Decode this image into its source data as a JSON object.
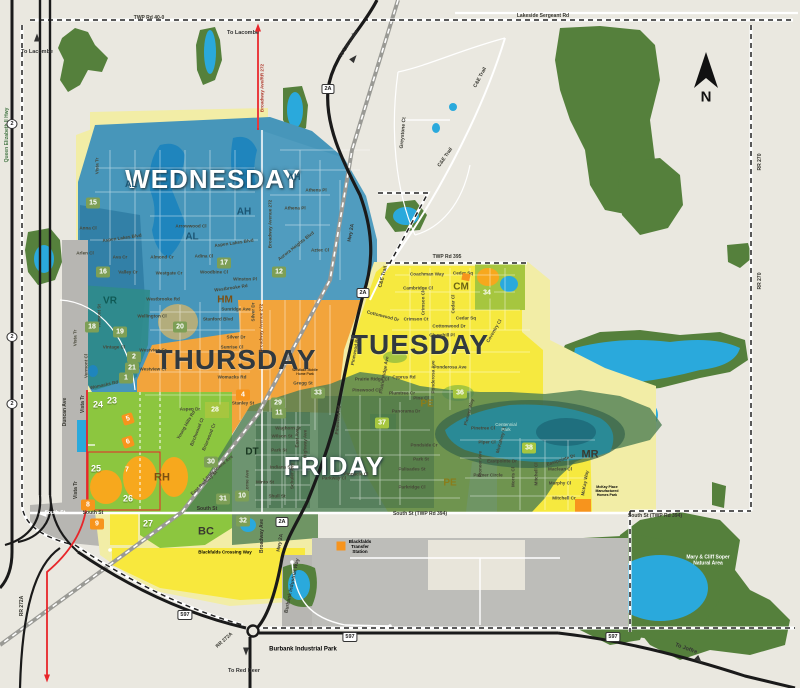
{
  "map": {
    "colors": {
      "background": "#eae8e0",
      "forest": "#55803c",
      "water": "#2aa9dc",
      "wednesday_zone": "#4796ba",
      "thursday_zone": "#f2a43c",
      "tuesday_zone": "#f6e93f",
      "friday_zone": "#4e7e54",
      "collection_green_zone": "#8cc63f",
      "pale_yellow_zone": "#f2eda6",
      "gray_zone": "#b7b6b2",
      "highway": "#1a1a1a",
      "route_red": "#e8262a",
      "marker_green": "#7d9f56",
      "marker_lime": "#a6c63f",
      "marker_orange": "#f7941d"
    },
    "compass": {
      "label": "N"
    },
    "day_zones": [
      {
        "t": "WEDNESDAY",
        "x": 213,
        "y": 180,
        "fs": 26,
        "cls": "day-light"
      },
      {
        "t": "THURSDAY",
        "x": 236,
        "y": 360,
        "fs": 28,
        "cls": "day-dark"
      },
      {
        "t": "TUESDAY",
        "x": 420,
        "y": 345,
        "fs": 28,
        "cls": "day-dark"
      },
      {
        "t": "FRIDAY",
        "x": 334,
        "y": 467,
        "fs": 26,
        "cls": "day-light"
      }
    ],
    "area_codes": [
      {
        "t": "AH",
        "x": 244,
        "y": 212,
        "fs": 10,
        "c": "#1c5674"
      },
      {
        "t": "AH",
        "x": 294,
        "y": 177,
        "fs": 9,
        "c": "#1c5674"
      },
      {
        "t": "AL",
        "x": 131,
        "y": 184,
        "fs": 9,
        "c": "#1c5674"
      },
      {
        "t": "AL",
        "x": 192,
        "y": 237,
        "fs": 10,
        "c": "#1c5674"
      },
      {
        "t": "VR",
        "x": 110,
        "y": 301,
        "fs": 10,
        "c": "#0f5a55"
      },
      {
        "t": "HM",
        "x": 225,
        "y": 300,
        "fs": 10,
        "c": "#7c4f12"
      },
      {
        "t": "CM",
        "x": 461,
        "y": 287,
        "fs": 10,
        "c": "#6b6414"
      },
      {
        "t": "PE",
        "x": 427,
        "y": 404,
        "fs": 10,
        "c": "#8a7d1a"
      },
      {
        "t": "PE",
        "x": 450,
        "y": 483,
        "fs": 10,
        "c": "#8a7d1a"
      },
      {
        "t": "DT",
        "x": 252,
        "y": 452,
        "fs": 10,
        "c": "#17351f"
      },
      {
        "t": "RH",
        "x": 162,
        "y": 478,
        "fs": 11,
        "c": "#7c4f12"
      },
      {
        "t": "BC",
        "x": 206,
        "y": 532,
        "fs": 11,
        "c": "#3a3a30"
      },
      {
        "t": "MR",
        "x": 590,
        "y": 455,
        "fs": 11,
        "c": "#3a3a30"
      }
    ],
    "markers": [
      {
        "t": "12",
        "x": 279,
        "y": 272,
        "cls": "green"
      },
      {
        "t": "15",
        "x": 93,
        "y": 203,
        "cls": "green"
      },
      {
        "t": "16",
        "x": 103,
        "y": 272,
        "cls": "green"
      },
      {
        "t": "17",
        "x": 224,
        "y": 263,
        "cls": "green"
      },
      {
        "t": "18",
        "x": 92,
        "y": 327,
        "cls": "green"
      },
      {
        "t": "19",
        "x": 120,
        "y": 332,
        "cls": "green"
      },
      {
        "t": "20",
        "x": 180,
        "y": 327,
        "cls": "green"
      },
      {
        "t": "2",
        "x": 134,
        "y": 357,
        "cls": "green"
      },
      {
        "t": "21",
        "x": 132,
        "y": 368,
        "cls": "green"
      },
      {
        "t": "1",
        "x": 126,
        "y": 378,
        "cls": "green"
      },
      {
        "t": "29",
        "x": 278,
        "y": 403,
        "cls": "green"
      },
      {
        "t": "11",
        "x": 279,
        "y": 413,
        "cls": "green"
      },
      {
        "t": "33",
        "x": 318,
        "y": 393,
        "cls": "green"
      },
      {
        "t": "30",
        "x": 211,
        "y": 462,
        "cls": "green"
      },
      {
        "t": "31",
        "x": 223,
        "y": 499,
        "cls": "green"
      },
      {
        "t": "10",
        "x": 242,
        "y": 496,
        "cls": "green"
      },
      {
        "t": "32",
        "x": 243,
        "y": 521,
        "cls": "green"
      },
      {
        "t": "34",
        "x": 487,
        "y": 293,
        "cls": "lime"
      },
      {
        "t": "36",
        "x": 460,
        "y": 393,
        "cls": "lime"
      },
      {
        "t": "37",
        "x": 382,
        "y": 423,
        "cls": "lime"
      },
      {
        "t": "28",
        "x": 215,
        "y": 410,
        "cls": "lime"
      },
      {
        "t": "38",
        "x": 529,
        "y": 448,
        "cls": "lime"
      },
      {
        "t": "4",
        "x": 243,
        "y": 395,
        "cls": "orange"
      },
      {
        "t": "8",
        "x": 88,
        "y": 505,
        "cls": "orange"
      },
      {
        "t": "9",
        "x": 97,
        "y": 524,
        "cls": "orange"
      },
      {
        "t": "5",
        "x": 128,
        "y": 419,
        "cls": "tilt"
      },
      {
        "t": "6",
        "x": 128,
        "y": 442,
        "cls": "tilt"
      },
      {
        "t": "7",
        "x": 127,
        "y": 470,
        "cls": "t ilt"
      },
      {
        "t": "23",
        "x": 112,
        "y": 400,
        "cls": "plain"
      },
      {
        "t": "24",
        "x": 98,
        "y": 404,
        "cls": "plain"
      },
      {
        "t": "25",
        "x": 96,
        "y": 468,
        "cls": "plain"
      },
      {
        "t": "26",
        "x": 128,
        "y": 498,
        "cls": "plain"
      },
      {
        "t": "27",
        "x": 148,
        "y": 523,
        "cls": "plain"
      }
    ],
    "streets": [
      {
        "t": "Vista Tr",
        "x": 97,
        "y": 166,
        "r": -90
      },
      {
        "t": "Anna Cl",
        "x": 88,
        "y": 228
      },
      {
        "t": "Aspen Lakes Blvd",
        "x": 122,
        "y": 238,
        "r": -8
      },
      {
        "t": "Arlen Cl",
        "x": 85,
        "y": 253
      },
      {
        "t": "Ava Cr",
        "x": 120,
        "y": 257
      },
      {
        "t": "Valley Cr",
        "x": 128,
        "y": 272
      },
      {
        "t": "Westgate Cr",
        "x": 169,
        "y": 273
      },
      {
        "t": "Almond Cr",
        "x": 162,
        "y": 257
      },
      {
        "t": "Adina Cl",
        "x": 204,
        "y": 256
      },
      {
        "t": "Woodbine Cl",
        "x": 214,
        "y": 272
      },
      {
        "t": "Arrowwood Cl",
        "x": 191,
        "y": 226
      },
      {
        "t": "Aspen Lakes Blvd",
        "x": 234,
        "y": 243,
        "r": -8
      },
      {
        "t": "Athena Pl",
        "x": 295,
        "y": 208
      },
      {
        "t": "Athens Pl",
        "x": 316,
        "y": 190
      },
      {
        "t": "Aurora Heights Blvd",
        "x": 296,
        "y": 246,
        "r": -38
      },
      {
        "t": "Aztec Cl",
        "x": 320,
        "y": 250
      },
      {
        "t": "Winston Pl",
        "x": 245,
        "y": 279
      },
      {
        "t": "Westbrooke Rd",
        "x": 163,
        "y": 299
      },
      {
        "t": "Westbrooke Rd",
        "x": 231,
        "y": 288,
        "r": -8
      },
      {
        "t": "Wellington Cl",
        "x": 152,
        "y": 316
      },
      {
        "t": "Vista Tr",
        "x": 75,
        "y": 338,
        "r": -90
      },
      {
        "t": "Valmont St",
        "x": 99,
        "y": 316,
        "r": -90
      },
      {
        "t": "Vintage Cl",
        "x": 114,
        "y": 347
      },
      {
        "t": "Vermont Cl",
        "x": 86,
        "y": 366,
        "r": -90
      },
      {
        "t": "Womacks Rd",
        "x": 104,
        "y": 385,
        "r": -12
      },
      {
        "t": "Broadway Ave/RR 272",
        "x": 262,
        "y": 88,
        "r": -90,
        "c": "#b03a2e"
      },
      {
        "t": "Broadway Avenue 272",
        "x": 270,
        "y": 224,
        "r": -90
      },
      {
        "t": "Sunridge Ave",
        "x": 236,
        "y": 309
      },
      {
        "t": "Stanford Blvd",
        "x": 218,
        "y": 319
      },
      {
        "t": "Silver Dr",
        "x": 236,
        "y": 337
      },
      {
        "t": "Silver Dr",
        "x": 253,
        "y": 312,
        "r": -90
      },
      {
        "t": "Sunrise Cl",
        "x": 232,
        "y": 347
      },
      {
        "t": "Westview Cr",
        "x": 153,
        "y": 350
      },
      {
        "t": "Westview Cr",
        "x": 153,
        "y": 369
      },
      {
        "t": "Womacks Rd",
        "x": 232,
        "y": 377
      },
      {
        "t": "Stanley St",
        "x": 243,
        "y": 403
      },
      {
        "t": "Aspen Dr",
        "x": 190,
        "y": 409
      },
      {
        "t": "Gregg St",
        "x": 303,
        "y": 383
      },
      {
        "t": "Broadway Avenue 272",
        "x": 261,
        "y": 328,
        "r": -90,
        "c": "#8a4a1a"
      },
      {
        "t": "Young Hills Rd",
        "x": 186,
        "y": 425,
        "r": -60
      },
      {
        "t": "Birchwood Cl",
        "x": 197,
        "y": 432,
        "r": -68
      },
      {
        "t": "Briarwood Cr",
        "x": 209,
        "y": 437,
        "r": -68
      },
      {
        "t": "Landsdowne Ave",
        "x": 218,
        "y": 468,
        "r": -40
      },
      {
        "t": "East Railway St",
        "x": 204,
        "y": 483,
        "r": -42
      },
      {
        "t": "Waghorn St",
        "x": 288,
        "y": 428
      },
      {
        "t": "Wilson St",
        "x": 282,
        "y": 436
      },
      {
        "t": "Park St",
        "x": 279,
        "y": 450
      },
      {
        "t": "Indiana St",
        "x": 281,
        "y": 467
      },
      {
        "t": "Minto St",
        "x": 265,
        "y": 482
      },
      {
        "t": "Shull St",
        "x": 277,
        "y": 496
      },
      {
        "t": "East Ave",
        "x": 297,
        "y": 438,
        "r": -90
      },
      {
        "t": "Highway Ave",
        "x": 305,
        "y": 444,
        "r": -90
      },
      {
        "t": "Schuler Ave",
        "x": 292,
        "y": 476,
        "r": -90
      },
      {
        "t": "Lorne Ave",
        "x": 247,
        "y": 481,
        "r": -90
      },
      {
        "t": "Panorama Dr",
        "x": 406,
        "y": 411
      },
      {
        "t": "Pondside Cr",
        "x": 424,
        "y": 445
      },
      {
        "t": "Park St",
        "x": 421,
        "y": 459
      },
      {
        "t": "Palisades St",
        "x": 412,
        "y": 469
      },
      {
        "t": "Parkridge Cl",
        "x": 412,
        "y": 487
      },
      {
        "t": "Pinnacle Cl",
        "x": 356,
        "y": 474
      },
      {
        "t": "Parkway Cl",
        "x": 334,
        "y": 478
      },
      {
        "t": "Pinewood Rd",
        "x": 338,
        "y": 420,
        "r": -85
      },
      {
        "t": "Pioneer Way",
        "x": 469,
        "y": 412,
        "r": -75
      },
      {
        "t": "Pinetree Cl",
        "x": 483,
        "y": 428
      },
      {
        "t": "Piper Cl",
        "x": 487,
        "y": 442
      },
      {
        "t": "Pioneer Ave",
        "x": 480,
        "y": 464,
        "r": -90
      },
      {
        "t": "McKalvey Cl",
        "x": 501,
        "y": 440,
        "r": -75
      },
      {
        "t": "Eastpointe Dr",
        "x": 502,
        "y": 461
      },
      {
        "t": "Palmer Circle",
        "x": 488,
        "y": 475
      },
      {
        "t": "Morris Cl",
        "x": 513,
        "y": 477,
        "r": -90
      },
      {
        "t": "Mitchell Cl",
        "x": 536,
        "y": 474,
        "r": -90
      },
      {
        "t": "Eastpointe Dr",
        "x": 561,
        "y": 460,
        "r": -18
      },
      {
        "t": "Maclean Cl",
        "x": 560,
        "y": 469
      },
      {
        "t": "Murphy Cl",
        "x": 560,
        "y": 483
      },
      {
        "t": "Mitchell Cr",
        "x": 564,
        "y": 498
      },
      {
        "t": "McKay Way",
        "x": 585,
        "y": 483,
        "r": -80
      },
      {
        "t": "Coachman Way",
        "x": 427,
        "y": 274
      },
      {
        "t": "Cedar Sq",
        "x": 463,
        "y": 273
      },
      {
        "t": "Cedar Sq",
        "x": 466,
        "y": 318
      },
      {
        "t": "Cambridge Cl",
        "x": 418,
        "y": 288
      },
      {
        "t": "Crimson Cl",
        "x": 423,
        "y": 303,
        "r": -90
      },
      {
        "t": "Crimson Ct",
        "x": 416,
        "y": 319
      },
      {
        "t": "Cottonwood Dr",
        "x": 449,
        "y": 326
      },
      {
        "t": "Cottonwood Dr",
        "x": 383,
        "y": 316,
        "r": 14
      },
      {
        "t": "Churchill Pl",
        "x": 442,
        "y": 335
      },
      {
        "t": "Cedar Cl",
        "x": 453,
        "y": 304,
        "r": -90
      },
      {
        "t": "Coventry Cl",
        "x": 494,
        "y": 331,
        "r": -60
      },
      {
        "t": "Ponderosa Ave",
        "x": 450,
        "y": 367
      },
      {
        "t": "Ponderosa Ave",
        "x": 433,
        "y": 377,
        "r": -90
      },
      {
        "t": "Cyprus Rd",
        "x": 404,
        "y": 377
      },
      {
        "t": "Prairie Ridge Ave",
        "x": 384,
        "y": 375,
        "r": -80
      },
      {
        "t": "Prairie Ridge Cl",
        "x": 372,
        "y": 379
      },
      {
        "t": "Pinewood Cl",
        "x": 366,
        "y": 390
      },
      {
        "t": "Plumtree Cr",
        "x": 402,
        "y": 393
      },
      {
        "t": "Pine Cl",
        "x": 421,
        "y": 398
      },
      {
        "t": "Pinewood Rd",
        "x": 355,
        "y": 351,
        "r": -80
      }
    ],
    "road_labels": [
      {
        "t": "TWP Rd 40-0",
        "x": 149,
        "y": 19
      },
      {
        "t": "Lakeside Sergeant Rd",
        "x": 543,
        "y": 17
      },
      {
        "t": "TWP Rd 395",
        "x": 447,
        "y": 258
      },
      {
        "t": "C&E Trail",
        "x": 481,
        "y": 78,
        "r": -62
      },
      {
        "t": "C&E Trail",
        "x": 446,
        "y": 158,
        "r": -55
      },
      {
        "t": "C&E Trail",
        "x": 384,
        "y": 277,
        "r": -75
      },
      {
        "t": "Greystone Ct",
        "x": 404,
        "y": 133,
        "r": -85
      },
      {
        "t": "Hwy 2A",
        "x": 352,
        "y": 233,
        "r": -80
      },
      {
        "t": "Hwy 2A",
        "x": 281,
        "y": 543,
        "r": -80
      },
      {
        "t": "Broadway Ave",
        "x": 263,
        "y": 536,
        "r": -90
      },
      {
        "t": "Burbank Industrial Way",
        "x": 293,
        "y": 586,
        "r": -78
      },
      {
        "t": "South St (TWP Rd 394)",
        "x": 420,
        "y": 515
      },
      {
        "t": "South St (TWP Rd 394)",
        "x": 655,
        "y": 517
      },
      {
        "t": "South St",
        "x": 93,
        "y": 514
      },
      {
        "t": "South St",
        "x": 55,
        "y": 514,
        "c": "#ffffff"
      },
      {
        "t": "South St",
        "x": 207,
        "y": 510
      },
      {
        "t": "RR 272A",
        "x": 23,
        "y": 606,
        "r": -90
      },
      {
        "t": "RR 272A",
        "x": 225,
        "y": 641,
        "r": -42
      },
      {
        "t": "RR 270",
        "x": 761,
        "y": 162,
        "r": -90
      },
      {
        "t": "RR 270",
        "x": 761,
        "y": 281,
        "r": -90
      },
      {
        "t": "Queen Elizabeth II Hwy",
        "x": 8,
        "y": 135,
        "r": -90,
        "c": "#4a7a4a"
      },
      {
        "t": "Duncan Ave",
        "x": 66,
        "y": 412,
        "r": -90
      },
      {
        "t": "Vista Tr",
        "x": 84,
        "y": 404,
        "r": -90
      },
      {
        "t": "Vista Tr",
        "x": 77,
        "y": 490,
        "r": -90
      }
    ],
    "directions": [
      {
        "t": "To Lacombe",
        "x": 37,
        "y": 52
      },
      {
        "t": "To Lacombe",
        "x": 243,
        "y": 33
      },
      {
        "t": "To Lacombe",
        "x": 349,
        "y": 44,
        "r": -58
      },
      {
        "t": "To Red Deer",
        "x": 244,
        "y": 671
      },
      {
        "t": "To Joffre",
        "x": 686,
        "y": 649,
        "r": 20
      }
    ],
    "landmarks": [
      {
        "t": "Burbank Industrial Park",
        "x": 303,
        "y": 650,
        "fs": 6,
        "cls": "bold"
      },
      {
        "t": "Mary & Cliff Soper\nNatural Area",
        "x": 708,
        "y": 561,
        "fs": 5,
        "c": "#ffffff",
        "cls": "bold"
      },
      {
        "t": "Centennial\nPark",
        "x": 506,
        "y": 427,
        "fs": 4.5,
        "c": "#cfe8dc"
      },
      {
        "t": "Blackfalds\nTransfer\nStation",
        "x": 360,
        "y": 547,
        "fs": 4.5,
        "cls": "bold"
      },
      {
        "t": "Blackfalds Crossing Way",
        "x": 225,
        "y": 552,
        "fs": 4.5,
        "cls": "bold"
      },
      {
        "t": "Westlake Mobile\nHome Park",
        "x": 305,
        "y": 372,
        "fs": 3.5
      },
      {
        "t": "McKay Place\nManufactured\nHomes Park",
        "x": 607,
        "y": 491,
        "fs": 3.5,
        "cls": "bold"
      }
    ],
    "shields": [
      {
        "t": "2A",
        "x": 328,
        "y": 89
      },
      {
        "t": "2A",
        "x": 363,
        "y": 293
      },
      {
        "t": "2A",
        "x": 282,
        "y": 522
      },
      {
        "t": "597",
        "x": 185,
        "y": 615
      },
      {
        "t": "597",
        "x": 350,
        "y": 637
      },
      {
        "t": "597",
        "x": 613,
        "y": 637
      },
      {
        "t": "2",
        "x": 12,
        "y": 124,
        "cls": "oval"
      },
      {
        "t": "2",
        "x": 12,
        "y": 337,
        "cls": "oval"
      },
      {
        "t": "2",
        "x": 12,
        "y": 404,
        "cls": "oval"
      }
    ],
    "arrows": [
      {
        "cls": "up",
        "x": 37,
        "y": 36,
        "c": "#333333"
      },
      {
        "cls": "up",
        "x": 258,
        "y": 26,
        "c": "#e8262a"
      },
      {
        "cls": "up",
        "x": 355,
        "y": 57,
        "c": "#333333",
        "r": 40
      },
      {
        "cls": "down",
        "x": 246,
        "y": 653,
        "c": "#333333"
      },
      {
        "cls": "down",
        "x": 47,
        "y": 680,
        "c": "#e8262a"
      },
      {
        "cls": "down",
        "x": 700,
        "y": 661,
        "c": "#333333",
        "r": -45
      },
      {
        "cls": "left",
        "x": 41,
        "y": 514,
        "c": "#ffffff"
      }
    ]
  }
}
